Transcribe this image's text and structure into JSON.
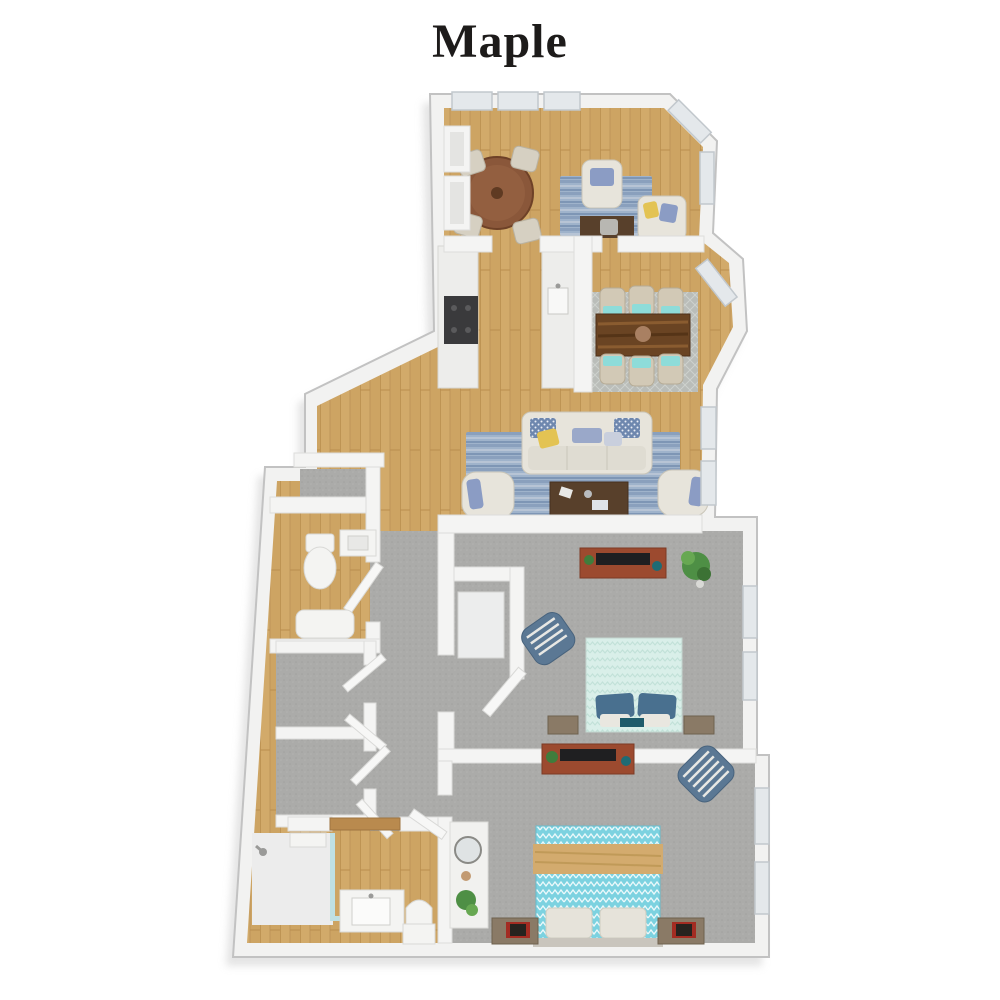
{
  "title": "Maple",
  "palette": {
    "background": "#ffffff",
    "title_text": "#1d1b1a",
    "outer_wall": "#f2f2f1",
    "wall_outline": "#c2c2c2",
    "drop_shadow": "#c9c9c9",
    "wood_floor": "#cda463",
    "wood_plank_line": "#b98e4f",
    "carpet": "#ababa9",
    "bath_tile": "#ececec",
    "window_glass": "#e4e8eb",
    "rug_living_blue": "#9fb3cb",
    "rug_dining_gray": "#babdb9",
    "sofa_cream": "#e7e4db",
    "pillow_blue": "#8b9cc4",
    "pillow_yellow": "#e3c353",
    "pillow_navy_check": "#6e87ae",
    "round_table_wood": "#8a573a",
    "dining_table_wood": "#6a4423",
    "coffee_table_wood": "#58402b",
    "dresser_wood": "#9c4a2f",
    "tv_black": "#1f1f21",
    "bed1_mint": "#d9efe9",
    "bed1_pillow_blue": "#49708f",
    "bed2_aqua": "#7cd2e0",
    "bed2_throw_tan": "#d3ab6e",
    "accent_chair_blue": "#5b7894",
    "accent_chair_stripe": "#e8e8e4",
    "plant_green": "#4e8f45",
    "shower_glass": "#bfe0e3",
    "range_black": "#3a3a3c",
    "door_wood": "#b98a4e",
    "books_red": "#a32c22"
  },
  "floorplan": {
    "name": "Maple",
    "view": "3d-top-down-render",
    "rooms": [
      {
        "id": "den",
        "floor": "hardwood",
        "contents": [
          "round-table",
          "four-chairs",
          "armchair",
          "loveseat",
          "desk",
          "blue-rug",
          "windows"
        ]
      },
      {
        "id": "kitchen",
        "floor": "hardwood",
        "contents": [
          "counter-left",
          "range",
          "counter-right",
          "sink"
        ]
      },
      {
        "id": "dining-room",
        "floor": "hardwood",
        "contents": [
          "dining-table",
          "six-chairs",
          "gray-rug",
          "bay-window"
        ]
      },
      {
        "id": "living-room",
        "floor": "hardwood",
        "contents": [
          "sofa",
          "two-armchairs",
          "coffee-table",
          "striped-rug",
          "windows"
        ]
      },
      {
        "id": "hallway",
        "floor": "hardwood-to-carpet",
        "contents": [
          "open-doors"
        ]
      },
      {
        "id": "half-bath",
        "floor": "hardwood",
        "contents": [
          "toilet",
          "vanity",
          "tub"
        ]
      },
      {
        "id": "closets",
        "floor": "carpet",
        "contents": [
          "two-reach-in-closets",
          "linen-closet"
        ]
      },
      {
        "id": "bedroom-1",
        "floor": "carpet",
        "contents": [
          "bed-mint",
          "dresser-tv",
          "striped-accent-chair",
          "nightstands",
          "plant",
          "walk-in-closet",
          "windows"
        ]
      },
      {
        "id": "bedroom-2",
        "floor": "carpet",
        "contents": [
          "bed-aqua-chevron",
          "tan-throw",
          "dresser-tv",
          "striped-accent-chair",
          "nightstands",
          "vanity-desk-mirror",
          "plant",
          "windows"
        ]
      },
      {
        "id": "bathroom",
        "floor": "hardwood",
        "contents": [
          "walk-in-shower",
          "glass-panel",
          "vanity-sink",
          "toilet",
          "wood-door"
        ]
      }
    ]
  }
}
